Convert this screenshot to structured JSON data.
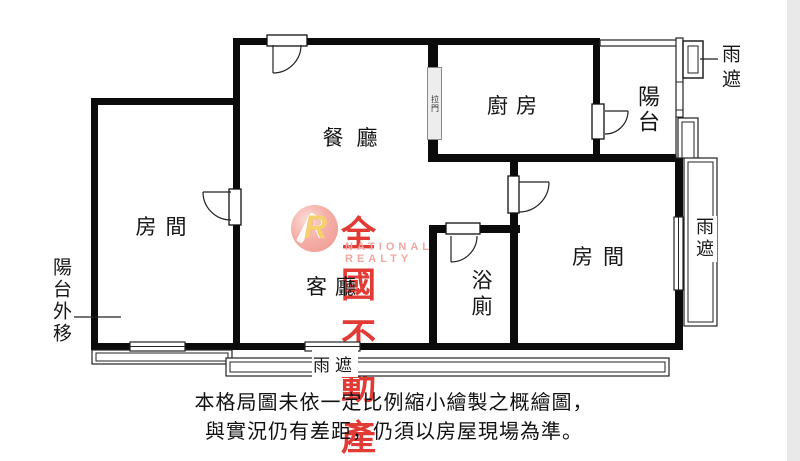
{
  "plan": {
    "rooms": {
      "dining": "餐廳",
      "kitchen": "廚房",
      "balcony": "陽台",
      "bedroom_left": "房間",
      "bedroom_right": "房間",
      "living": "客廳",
      "bath": "浴廁"
    },
    "annotations": {
      "rain_shelter_top": "雨遮",
      "rain_shelter_right": "雨遮",
      "rain_shelter_bottom": "雨遮",
      "balcony_shifted_out": "陽台外移",
      "sliding_door": "拉門"
    }
  },
  "watermark": {
    "monogram": "R",
    "brand": "全國不動產",
    "brand_en": "NATIONAL REALTY"
  },
  "disclaimer": {
    "line1": "本格局圖未依一定比例縮小繪製之概繪圖，",
    "line2": "與實況仍有差距，仍須以房屋現場為準。"
  },
  "colors": {
    "wall": "#0b0b0b",
    "line": "#222222",
    "brand_red": "#e23a34",
    "brand_pink": "#f2a7a0",
    "sliding_fill": "#ededed"
  }
}
